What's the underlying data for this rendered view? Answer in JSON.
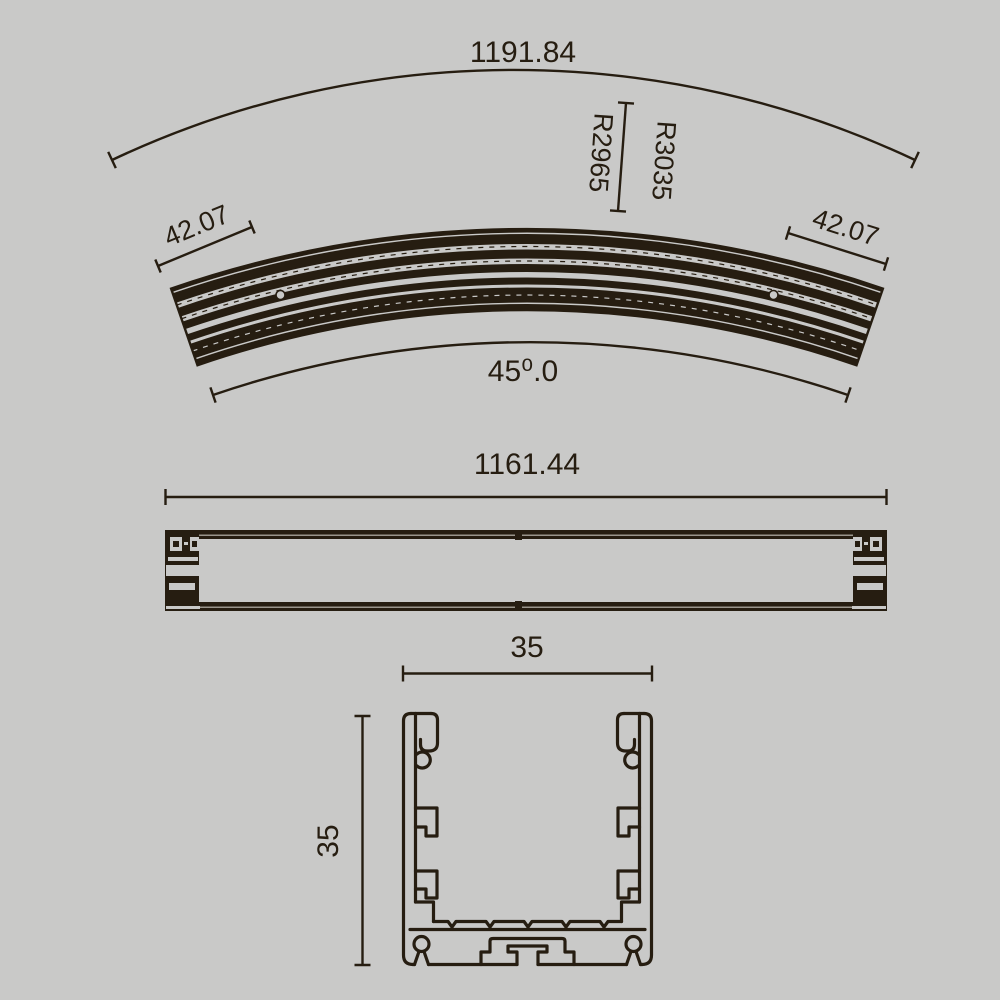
{
  "drawing": {
    "title": "curved-led-profile-technical-drawing",
    "ink_color": "#261d11",
    "background_color": "#c9c9c8",
    "plan_view": {
      "outer_arc_length_label": "1191.84",
      "radius_outer_label": "R3035",
      "radius_inner_label": "R2965",
      "end_width_left_label": "42.07",
      "end_width_right_label": "42.07",
      "angle_label": "45⁰.0"
    },
    "side_view": {
      "length_label": "1161.44"
    },
    "cross_section_view": {
      "width_label": "35",
      "height_label": "35"
    }
  }
}
